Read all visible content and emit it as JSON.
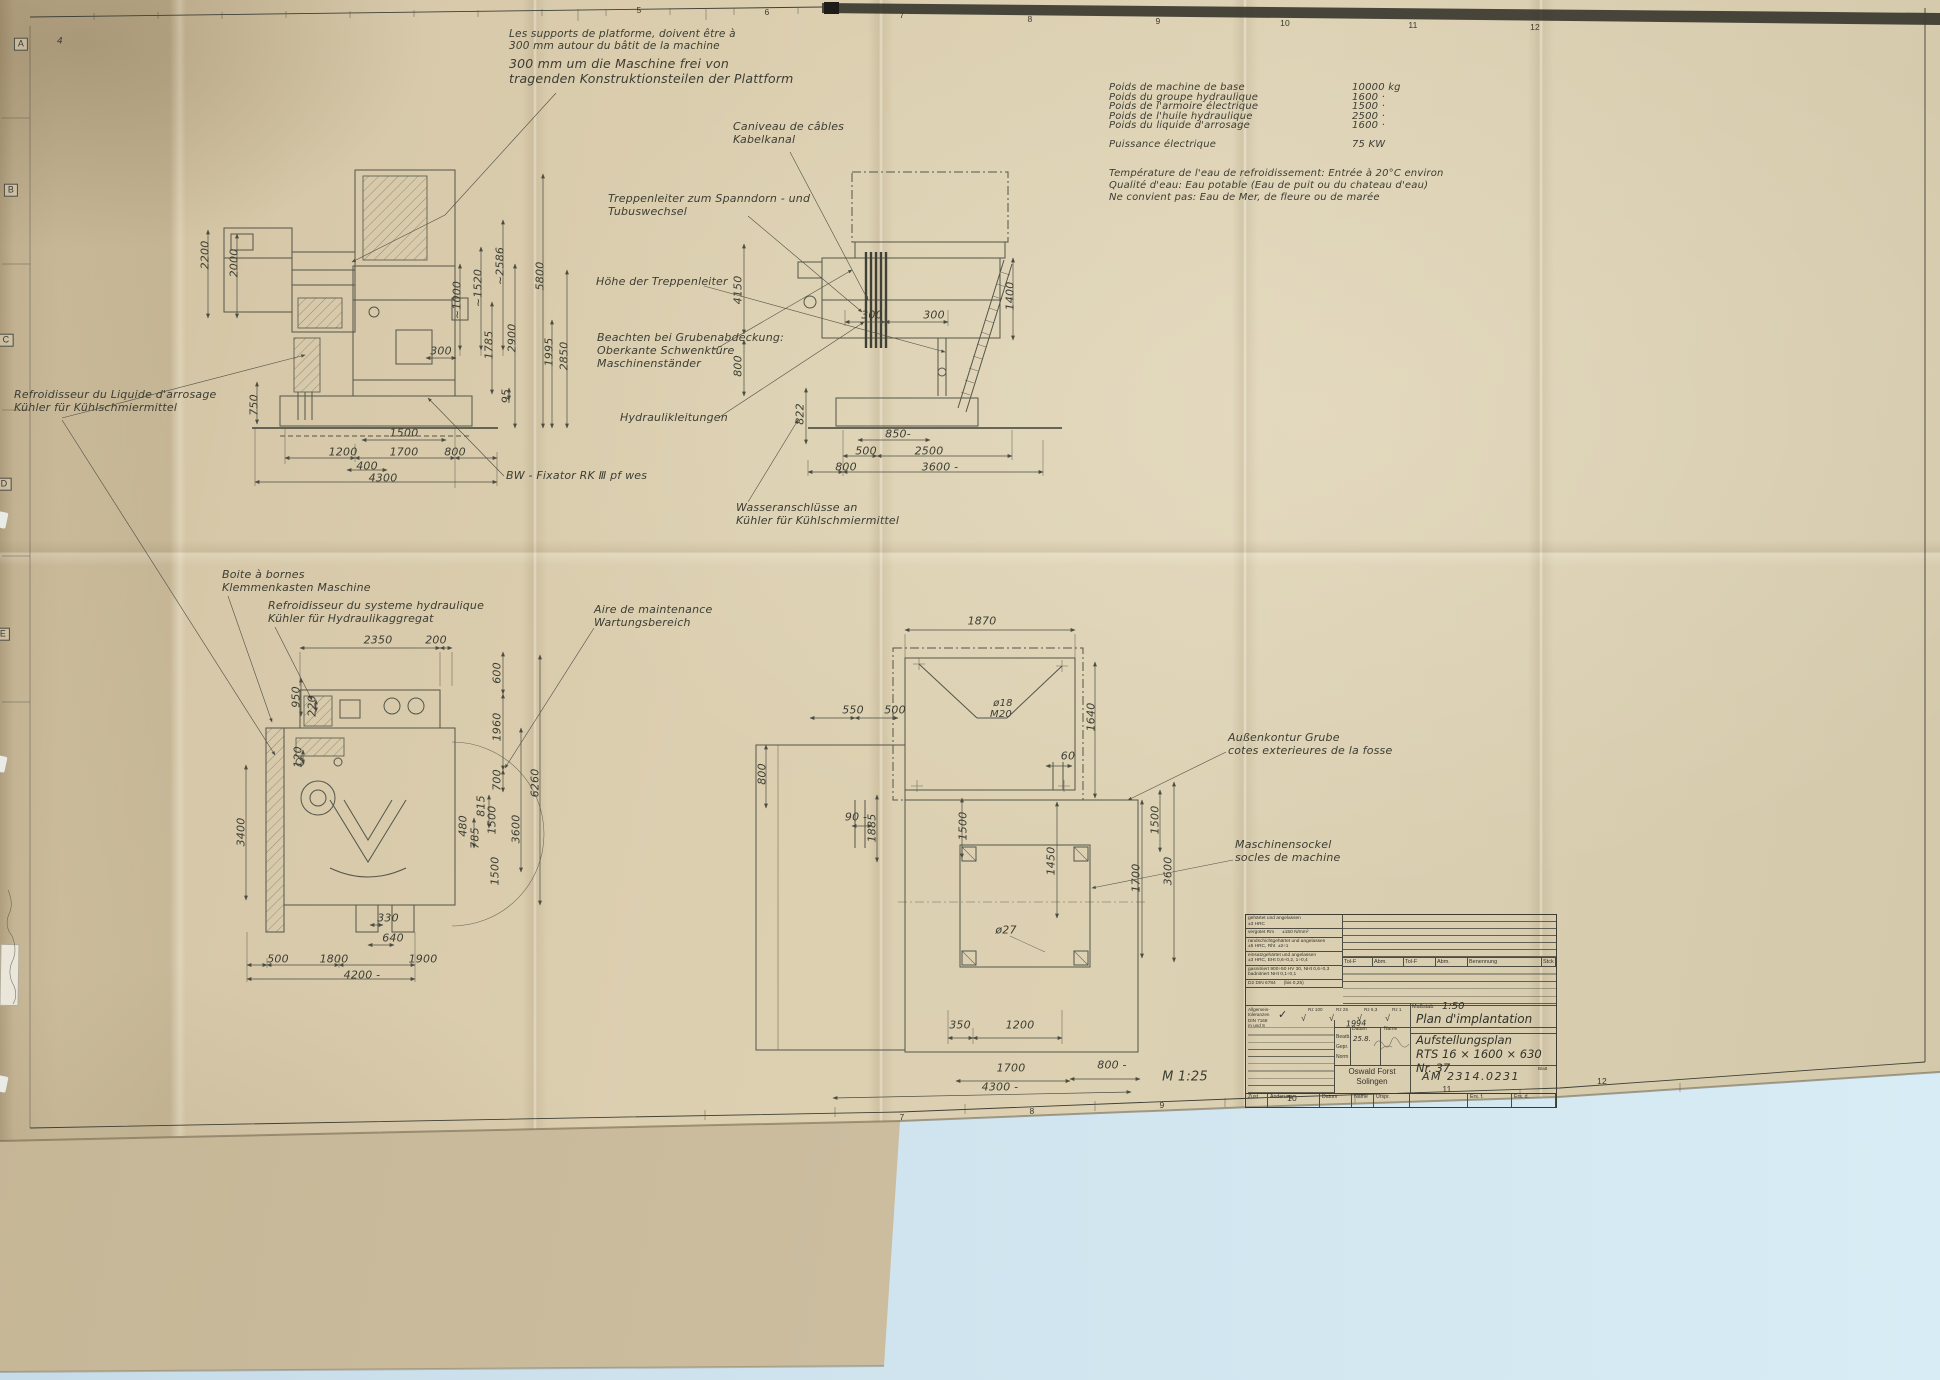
{
  "palette": {
    "paper": "#d8cbab",
    "paper_dark": "#c9b897",
    "under_sheet": "#cbbd9e",
    "background_blue": "#cfe3ee",
    "line": "#53554a",
    "ink": "#3c3d33",
    "ruler_band": "#26261f"
  },
  "spec_table": {
    "label_x": 1109,
    "value_x": 1352,
    "fs": 10,
    "rows": [
      {
        "label": "Poids de machine de base",
        "value": "10000 kg",
        "y": 82
      },
      {
        "label": "Poids du groupe hydraulique",
        "value": "1600 ·",
        "y": 91.5
      },
      {
        "label": "Poids de l'armoire électrique",
        "value": "1500 ·",
        "y": 101
      },
      {
        "label": "Poids de l'huile hydraulique",
        "value": "2500 ·",
        "y": 110.5
      },
      {
        "label": "Poids du liquide d'arrosage",
        "value": "1600 ·",
        "y": 120
      },
      {
        "label": "Puissance électrique",
        "value": "75 KW",
        "y": 139
      }
    ]
  },
  "annotations": {
    "platform_note_fr": [
      {
        "t": "Les supports de platforme, doivent être à\n300 mm autour du bâtit de la machine",
        "x": 509,
        "y": 28
      }
    ],
    "platform_note_de": [
      {
        "t": "300 mm um die Maschine frei von\ntragenden Konstruktionsteilen der  Plattform",
        "x": 509,
        "y": 57
      }
    ],
    "water_note": [
      {
        "t": "Température de l'eau de refroidissement: Entrée à 20°C environ\nQualité d'eau: Eau potable (Eau de puit ou du chateau d'eau)\nNe convient pas: Eau de Mer, de fleure ou de marée",
        "x": 1109,
        "y": 168
      }
    ],
    "callouts": [
      {
        "t": "Caniveau de câbles\nKabelkanal",
        "x": 733,
        "y": 121
      },
      {
        "t": "Treppenleiter zum Spanndorn - und\nTubuswechsel",
        "x": 608,
        "y": 193
      },
      {
        "t": "Höhe der Treppenleiter",
        "x": 596,
        "y": 276
      },
      {
        "t": "Beachten bei Grubenabdeckung:\nOberkante Schwenktüre\nMaschinenständer",
        "x": 597,
        "y": 332
      },
      {
        "t": "Hydraulikleitungen",
        "x": 620,
        "y": 412
      },
      {
        "t": "BW - Fixator RK Ⅲ pf wes",
        "x": 506,
        "y": 470
      },
      {
        "t": "Wasseranschlüsse an\nKühler für Kühlschmiermittel",
        "x": 736,
        "y": 502
      },
      {
        "t": "Refroidisseur du Liquide d'arrosage\nKühler für Kühlschmiermittel",
        "x": 14,
        "y": 389
      },
      {
        "t": "Boite à bornes\nKlemmenkasten Maschine",
        "x": 222,
        "y": 569
      },
      {
        "t": "Refroidisseur du systeme hydraulique\nKühler für Hydraulikaggregat",
        "x": 268,
        "y": 600
      },
      {
        "t": "Aire de maintenance\nWartungsbereich",
        "x": 594,
        "y": 604
      },
      {
        "t": "Außenkontur Grube\ncotes exterieures de la fosse",
        "x": 1228,
        "y": 732
      },
      {
        "t": "Maschinensockel\nsocles de machine",
        "x": 1235,
        "y": 839
      }
    ],
    "dims_front": [
      {
        "t": "2200",
        "x": 206,
        "y": 255,
        "r": -90
      },
      {
        "t": "2000",
        "x": 235,
        "y": 263,
        "r": -90
      },
      {
        "t": "~1000",
        "x": 458,
        "y": 300,
        "r": -90
      },
      {
        "t": "~1520",
        "x": 479,
        "y": 288,
        "r": -90
      },
      {
        "t": "~2586",
        "x": 501,
        "y": 266,
        "r": -90
      },
      {
        "t": "5800",
        "x": 541,
        "y": 276,
        "r": -90
      },
      {
        "t": "300",
        "x": 441,
        "y": 352
      },
      {
        "t": "1785",
        "x": 490,
        "y": 345,
        "r": -90
      },
      {
        "t": "2900",
        "x": 513,
        "y": 338,
        "r": -90
      },
      {
        "t": "1995",
        "x": 550,
        "y": 352,
        "r": -90
      },
      {
        "t": "2850",
        "x": 565,
        "y": 356,
        "r": -90
      },
      {
        "t": "95",
        "x": 507,
        "y": 396,
        "r": -90
      },
      {
        "t": "750",
        "x": 255,
        "y": 405,
        "r": -90
      },
      {
        "t": "1500",
        "x": 404,
        "y": 434
      },
      {
        "t": "1200",
        "x": 343,
        "y": 453
      },
      {
        "t": "1700",
        "x": 404,
        "y": 453
      },
      {
        "t": "800",
        "x": 455,
        "y": 453
      },
      {
        "t": "400",
        "x": 367,
        "y": 467
      },
      {
        "t": "4300",
        "x": 383,
        "y": 479
      }
    ],
    "dims_side": [
      {
        "t": "4150",
        "x": 739,
        "y": 290,
        "r": -90
      },
      {
        "t": "800",
        "x": 739,
        "y": 366,
        "r": -90
      },
      {
        "t": "822",
        "x": 801,
        "y": 414,
        "r": -90
      },
      {
        "t": "1400",
        "x": 1011,
        "y": 296,
        "r": -90
      },
      {
        "t": "300",
        "x": 872,
        "y": 316
      },
      {
        "t": "300",
        "x": 934,
        "y": 316
      },
      {
        "t": "850-",
        "x": 898,
        "y": 435
      },
      {
        "t": "500",
        "x": 866,
        "y": 452
      },
      {
        "t": "2500",
        "x": 929,
        "y": 452
      },
      {
        "t": "800",
        "x": 846,
        "y": 468
      },
      {
        "t": "3600 -",
        "x": 940,
        "y": 468
      }
    ],
    "dims_plan": [
      {
        "t": "2350",
        "x": 378,
        "y": 641
      },
      {
        "t": "200",
        "x": 436,
        "y": 641
      },
      {
        "t": "600",
        "x": 498,
        "y": 673,
        "r": -90
      },
      {
        "t": "1960",
        "x": 498,
        "y": 727,
        "r": -90
      },
      {
        "t": "700",
        "x": 498,
        "y": 780,
        "r": -90
      },
      {
        "t": "6260",
        "x": 536,
        "y": 783,
        "r": -90
      },
      {
        "t": "950",
        "x": 297,
        "y": 697,
        "r": -90
      },
      {
        "t": "220",
        "x": 313,
        "y": 706,
        "r": -90
      },
      {
        "t": "120",
        "x": 299,
        "y": 757,
        "r": -90
      },
      {
        "t": "3400",
        "x": 242,
        "y": 832,
        "r": -90
      },
      {
        "t": "815",
        "x": 482,
        "y": 806,
        "r": -90
      },
      {
        "t": "1500",
        "x": 493,
        "y": 820,
        "r": -90
      },
      {
        "t": "480",
        "x": 464,
        "y": 826,
        "r": -90
      },
      {
        "t": "785",
        "x": 476,
        "y": 838,
        "r": -90
      },
      {
        "t": "3600",
        "x": 517,
        "y": 829,
        "r": -90
      },
      {
        "t": "1500",
        "x": 496,
        "y": 871,
        "r": -90
      },
      {
        "t": "330",
        "x": 388,
        "y": 919
      },
      {
        "t": "640",
        "x": 393,
        "y": 939
      },
      {
        "t": "500",
        "x": 278,
        "y": 960
      },
      {
        "t": "1800",
        "x": 334,
        "y": 960
      },
      {
        "t": "1900",
        "x": 423,
        "y": 960
      },
      {
        "t": "4200 -",
        "x": 362,
        "y": 976
      }
    ],
    "dims_pit": [
      {
        "t": "1870",
        "x": 982,
        "y": 622
      },
      {
        "t": "550",
        "x": 853,
        "y": 711
      },
      {
        "t": "500",
        "x": 895,
        "y": 711
      },
      {
        "t": "ø18",
        "x": 1003,
        "y": 704,
        "fs": 10
      },
      {
        "t": "M20",
        "x": 1001,
        "y": 715,
        "fs": 10
      },
      {
        "t": "1640",
        "x": 1092,
        "y": 717,
        "r": -90
      },
      {
        "t": "60",
        "x": 1068,
        "y": 757
      },
      {
        "t": "800",
        "x": 763,
        "y": 774,
        "r": -90
      },
      {
        "t": "90 -",
        "x": 856,
        "y": 818
      },
      {
        "t": "1885",
        "x": 873,
        "y": 828,
        "r": -90
      },
      {
        "t": "1500",
        "x": 964,
        "y": 826,
        "r": -90
      },
      {
        "t": "1450",
        "x": 1052,
        "y": 861,
        "r": -90
      },
      {
        "t": "1500",
        "x": 1156,
        "y": 820,
        "r": -90
      },
      {
        "t": "1700",
        "x": 1137,
        "y": 878,
        "r": -90
      },
      {
        "t": "3600",
        "x": 1169,
        "y": 871,
        "r": -90
      },
      {
        "t": "ø27",
        "x": 1006,
        "y": 931
      },
      {
        "t": "350",
        "x": 960,
        "y": 1026
      },
      {
        "t": "1200",
        "x": 1020,
        "y": 1026
      },
      {
        "t": "1700",
        "x": 1011,
        "y": 1069
      },
      {
        "t": "800 -",
        "x": 1112,
        "y": 1066
      },
      {
        "t": "4300 -",
        "x": 1000,
        "y": 1088
      }
    ],
    "scale_note": [
      {
        "t": "M 1:25",
        "x": 1185,
        "y": 1077,
        "fs": 13
      }
    ],
    "corner_mark": [
      {
        "t": "4",
        "x": 60,
        "y": 42,
        "fs": 9
      }
    ],
    "zone_letters": [
      {
        "t": "A",
        "x": 21,
        "y": 44
      },
      {
        "t": "B",
        "x": 11,
        "y": 190
      },
      {
        "t": "C",
        "x": 6,
        "y": 340
      },
      {
        "t": "D",
        "x": 4,
        "y": 484
      },
      {
        "t": "E",
        "x": 3,
        "y": 634
      }
    ],
    "zone_numbers_top": [
      {
        "t": "5",
        "x": 639,
        "y": 10
      },
      {
        "t": "6",
        "x": 767,
        "y": 12
      },
      {
        "t": "7",
        "x": 902,
        "y": 15
      },
      {
        "t": "8",
        "x": 1030,
        "y": 19
      },
      {
        "t": "9",
        "x": 1158,
        "y": 21
      },
      {
        "t": "10",
        "x": 1285,
        "y": 23
      },
      {
        "t": "11",
        "x": 1413,
        "y": 25
      },
      {
        "t": "12",
        "x": 1535,
        "y": 27
      }
    ],
    "zone_numbers_bottom": [
      {
        "t": "7",
        "x": 902,
        "y": 1117
      },
      {
        "t": "8",
        "x": 1032,
        "y": 1111
      },
      {
        "t": "9",
        "x": 1162,
        "y": 1105
      },
      {
        "t": "10",
        "x": 1292,
        "y": 1098
      },
      {
        "t": "11",
        "x": 1447,
        "y": 1089
      },
      {
        "t": "12",
        "x": 1602,
        "y": 1081
      }
    ]
  },
  "title_block": {
    "heat_rows": [
      "gehärtet und angelassen\n±3 HRC",
      "vergütet Rm      ±150 N/mm²",
      "randschichtgehärtet und angelassen\n±5 HRC, Rht  ±2÷1",
      "einsatzgehärtet und angelassen\n±3 HRC, EHt 0,6÷0,2, 1÷0,4",
      "gasnitriert 900÷50 HV 30, NHt 0,6÷0,3\nbadnitriert NHt 0,1÷0,1",
      "D2 DIN 6784      (bis 0,25)"
    ],
    "grid_columns": [
      "Tol-F",
      "Abm.",
      "Tol-F",
      "Abm.",
      "Benennung",
      "Stck"
    ],
    "general_tol": "Allgemein-\ntoleranzen\nDIN 7168\nm und S",
    "check": "✓",
    "roughness": [
      "Rz 100",
      "Rz 25",
      "Rz 6,3",
      "Rz 1"
    ],
    "masstab_label": "Maßstab",
    "masstab_value": "1:50",
    "title_fr": "Plan d'implantation",
    "title_de": "Aufstellungsplan\nRTS 16 × 1600 × 630 Nr. 37",
    "mini_headers": [
      "Datum",
      "Name"
    ],
    "mini_rows": [
      "Bearb.",
      "Gepr.",
      "Norm"
    ],
    "bearb_date": "25.8.",
    "scrawl": "1994",
    "company": "Oswald Forst\nSolingen",
    "number": "AM 2314.0231",
    "blatt": "Blatt",
    "bottom_cells": [
      "Zust",
      "Änderung",
      "Datum",
      "Name",
      "Urspr."
    ],
    "ers_f": "Ers. f.",
    "ers_d": "Ers. d."
  }
}
